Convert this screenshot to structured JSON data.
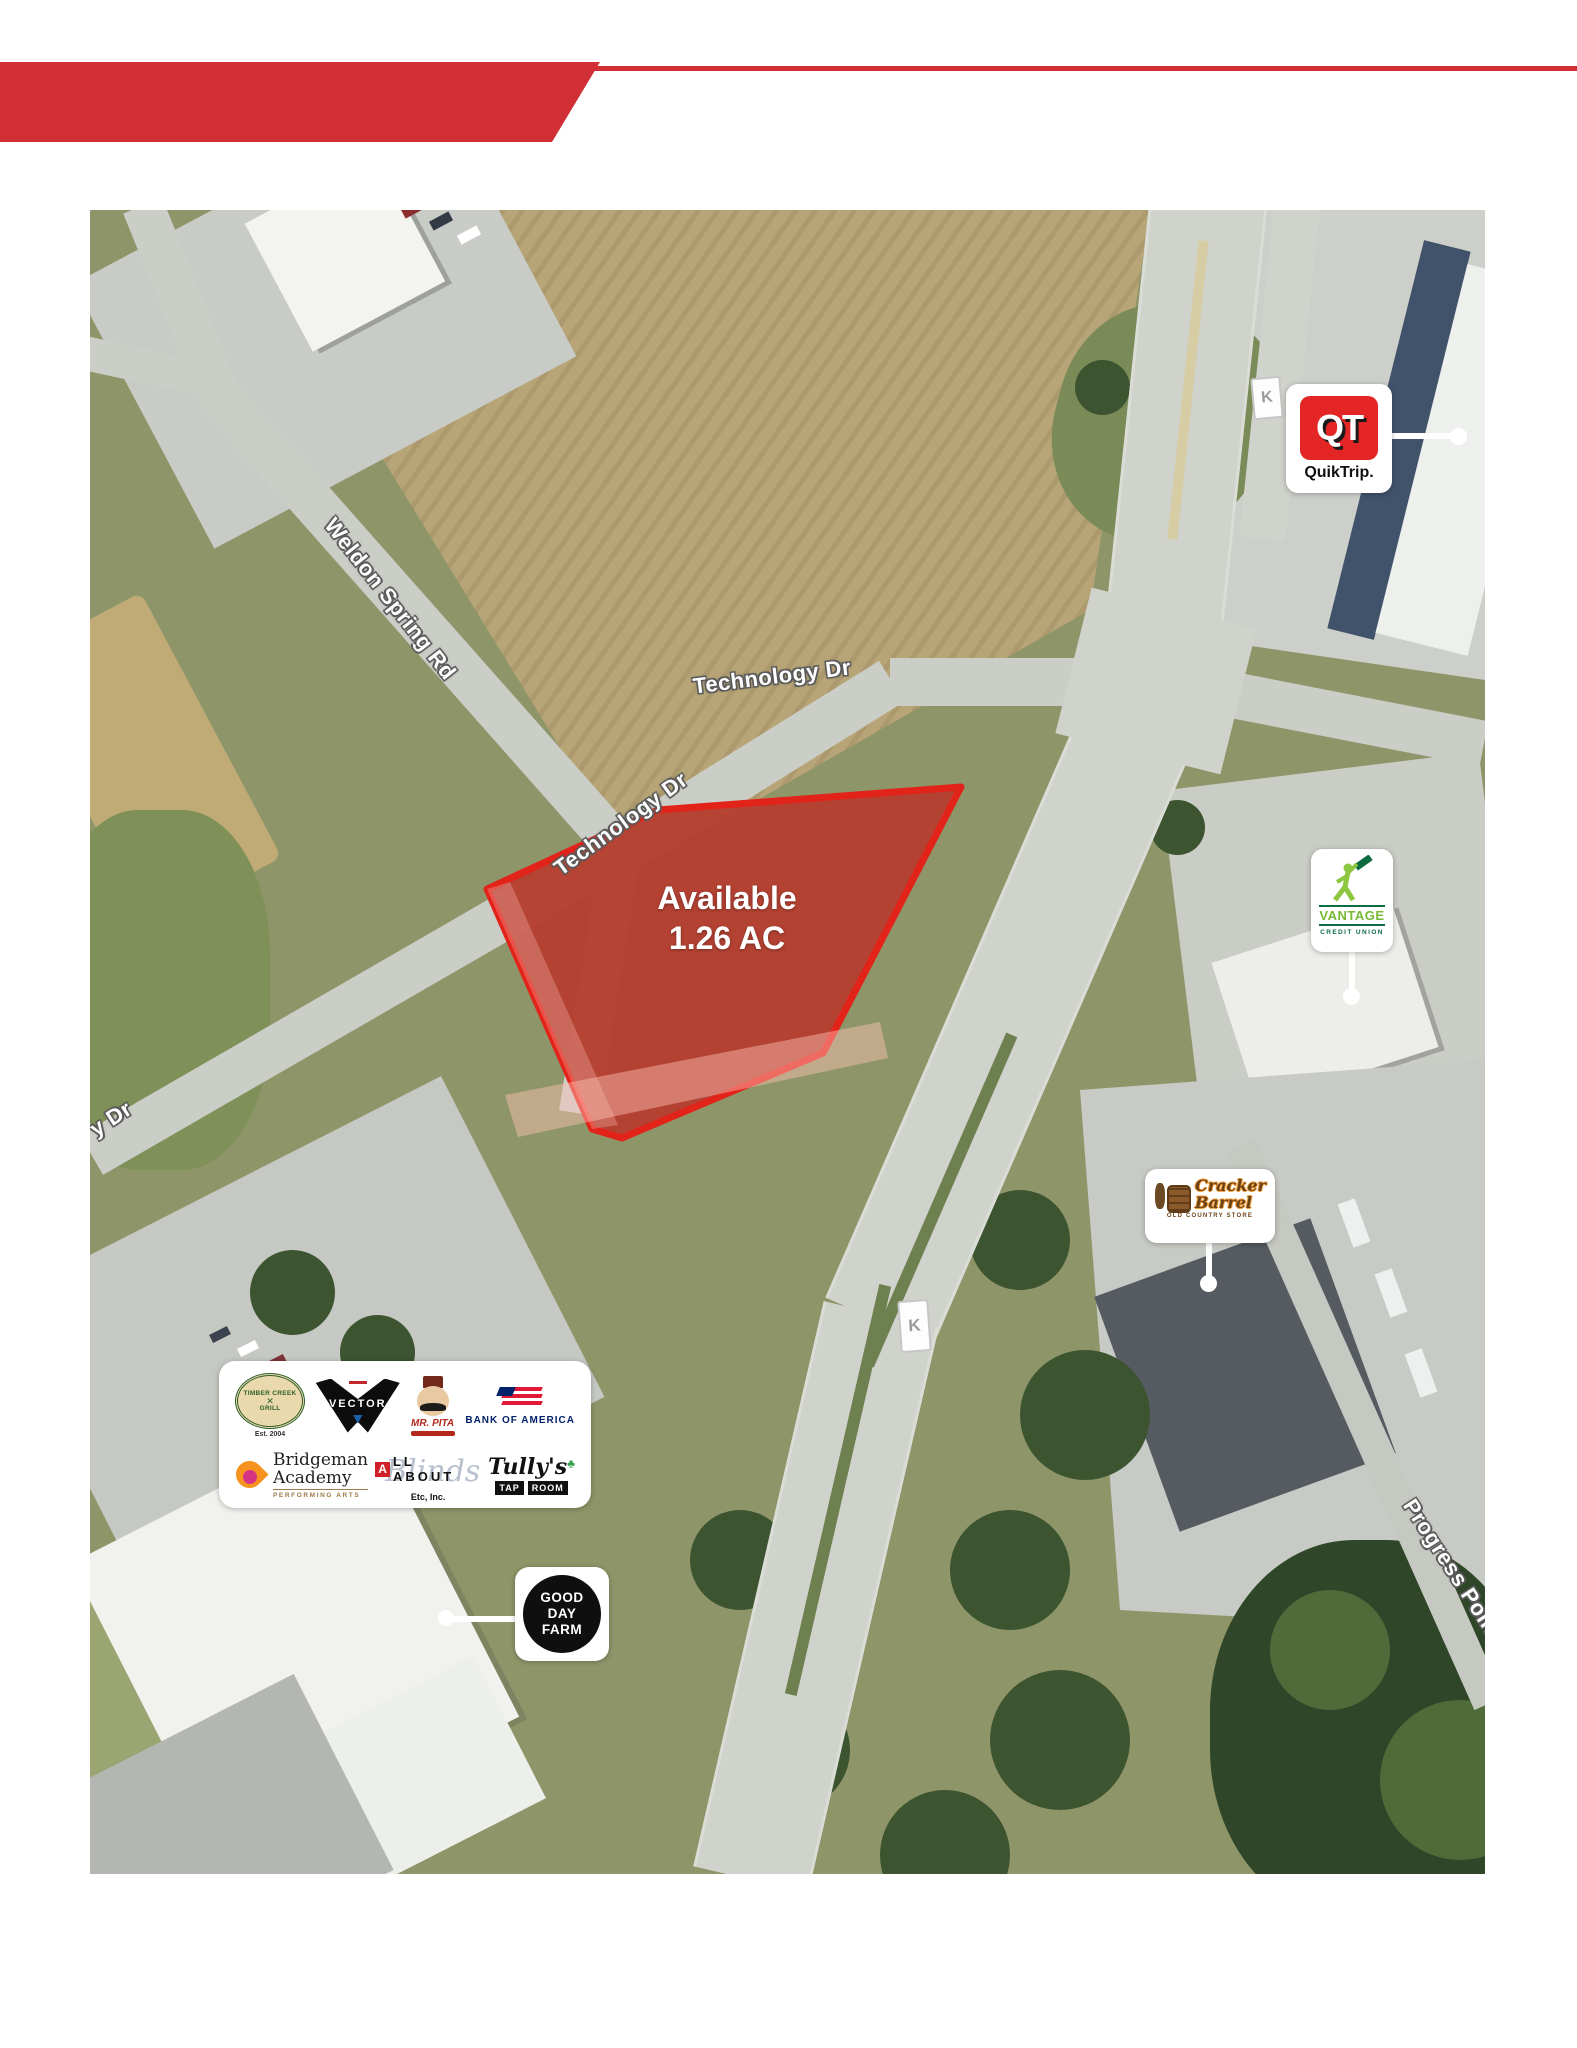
{
  "banner": {
    "title": "Site"
  },
  "parcel": {
    "line1": "Available",
    "line2": "1.26 AC"
  },
  "roads": {
    "technology_upper": "Technology Dr",
    "technology_lower": "Technology Dr",
    "weldon": "Weldon Spring Rd",
    "technology_edge": "y Dr",
    "progress": "Progress Point",
    "route_marker": "K"
  },
  "logos": {
    "quiktrip": {
      "abbr": "QT",
      "name": "QuikTrip."
    },
    "vantage": {
      "name": "VANTAGE",
      "tagline": "CREDIT UNION"
    },
    "cracker_barrel": {
      "line1": "Cracker",
      "line2": "Barrel",
      "tagline": "OLD COUNTRY STORE"
    },
    "good_day_farm": {
      "line1": "GOOD",
      "line2": "DAY",
      "line3": "FARM"
    },
    "timber_creek": {
      "line1": "TIMBER CREEK",
      "line2": "GRILL",
      "est": "Est. 2004"
    },
    "vector": {
      "name": "VECTOR"
    },
    "mr_pita": {
      "name": "MR. PITA"
    },
    "bank_of_america": {
      "name": "BANK OF AMERICA"
    },
    "bridgeman": {
      "line1": "Bridgeman",
      "line2": "Academy",
      "tagline": "PERFORMING ARTS"
    },
    "all_about_blinds": {
      "first": "A",
      "rest": "LL ABOUT",
      "script": "Blinds",
      "sub": "Etc, Inc."
    },
    "tullys": {
      "name": "Tully's",
      "shamrock": "♣",
      "tap": "TAP",
      "room": "ROOM"
    }
  },
  "colors": {
    "accent_red": "#d12f36",
    "parcel_red": "#e2231a",
    "map_green": "#8e9669",
    "road_gray": "#cbcdc7"
  }
}
